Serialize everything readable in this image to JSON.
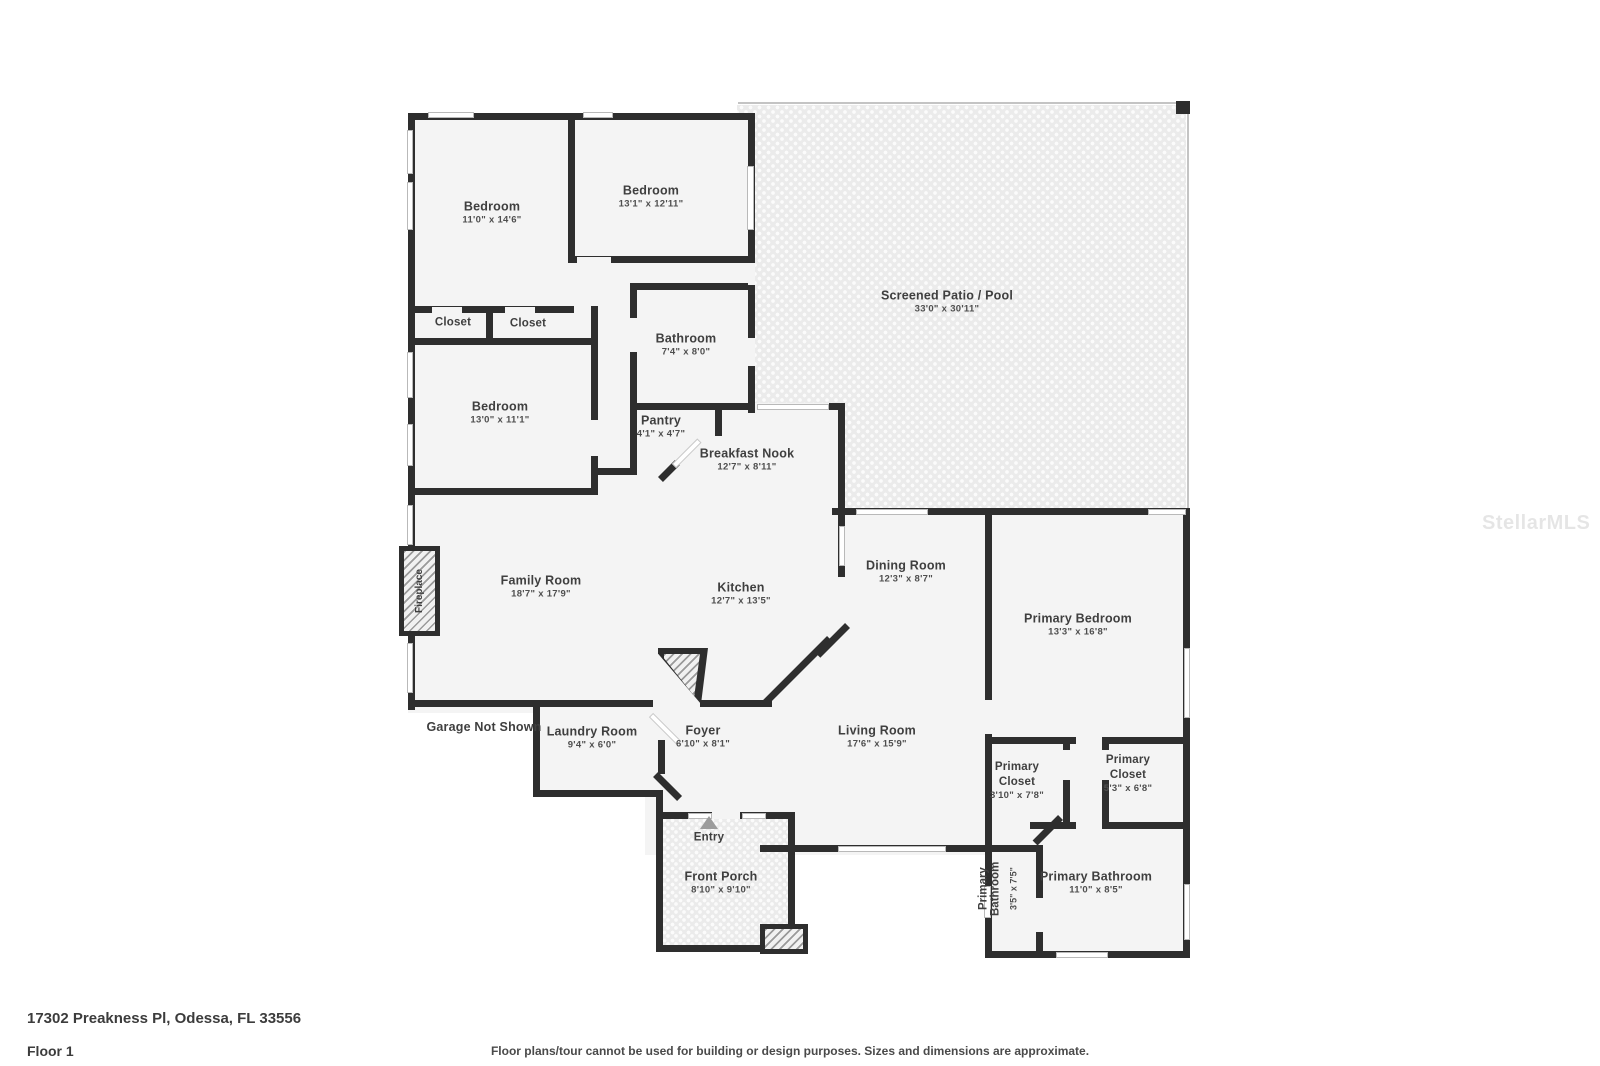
{
  "page": {
    "address": "17302 Preakness Pl, Odessa, FL 33556",
    "floor_label": "Floor 1",
    "disclaimer": "Floor plans/tour cannot be used for building or design purposes. Sizes and dimensions are approximate.",
    "watermark": "StellarMLS"
  },
  "rooms": [
    {
      "id": "bedroom-1",
      "name": "Bedroom",
      "dims": "11'0\" x 14'6\""
    },
    {
      "id": "bedroom-2",
      "name": "Bedroom",
      "dims": "13'1\" x 12'11\""
    },
    {
      "id": "screened-patio",
      "name": "Screened Patio / Pool",
      "dims": "33'0\" x 30'11\""
    },
    {
      "id": "closet-a",
      "name": "Closet",
      "dims": ""
    },
    {
      "id": "closet-b",
      "name": "Closet",
      "dims": ""
    },
    {
      "id": "bedroom-3",
      "name": "Bedroom",
      "dims": "13'0\" x 11'1\""
    },
    {
      "id": "bathroom",
      "name": "Bathroom",
      "dims": "7'4\" x 8'0\""
    },
    {
      "id": "pantry",
      "name": "Pantry",
      "dims": "4'1\" x 4'7\""
    },
    {
      "id": "breakfast-nook",
      "name": "Breakfast Nook",
      "dims": "12'7\" x 8'11\""
    },
    {
      "id": "family-room",
      "name": "Family Room",
      "dims": "18'7\" x 17'9\""
    },
    {
      "id": "kitchen",
      "name": "Kitchen",
      "dims": "12'7\" x 13'5\""
    },
    {
      "id": "dining-room",
      "name": "Dining Room",
      "dims": "12'3\" x 8'7\""
    },
    {
      "id": "primary-bedroom",
      "name": "Primary Bedroom",
      "dims": "13'3\" x 16'8\""
    },
    {
      "id": "living-room",
      "name": "Living Room",
      "dims": "17'6\" x 15'9\""
    },
    {
      "id": "laundry-room",
      "name": "Laundry Room",
      "dims": "9'4\" x 6'0\""
    },
    {
      "id": "foyer",
      "name": "Foyer",
      "dims": "6'10\" x 8'1\""
    },
    {
      "id": "garage-note",
      "name": "Garage Not Shown",
      "dims": ""
    },
    {
      "id": "primary-closet-a",
      "name": "Primary Closet",
      "dims": "3'10\" x 7'8\""
    },
    {
      "id": "primary-closet-b",
      "name": "Primary Closet",
      "dims": "5'3\" x 6'8\""
    },
    {
      "id": "primary-bathroom-small",
      "name": "Primary Bathroom",
      "dims": "3'5\" x 7'5\""
    },
    {
      "id": "primary-bathroom",
      "name": "Primary Bathroom",
      "dims": "11'0\" x 8'5\""
    },
    {
      "id": "front-porch",
      "name": "Front Porch",
      "dims": "8'10\" x 9'10\""
    },
    {
      "id": "entry",
      "name": "Entry",
      "dims": ""
    },
    {
      "id": "fireplace",
      "name": "Fireplace",
      "dims": ""
    }
  ],
  "colors": {
    "wall": "#2e2e2e",
    "floor": "#f4f4f4",
    "text": "#3f3f3f"
  }
}
